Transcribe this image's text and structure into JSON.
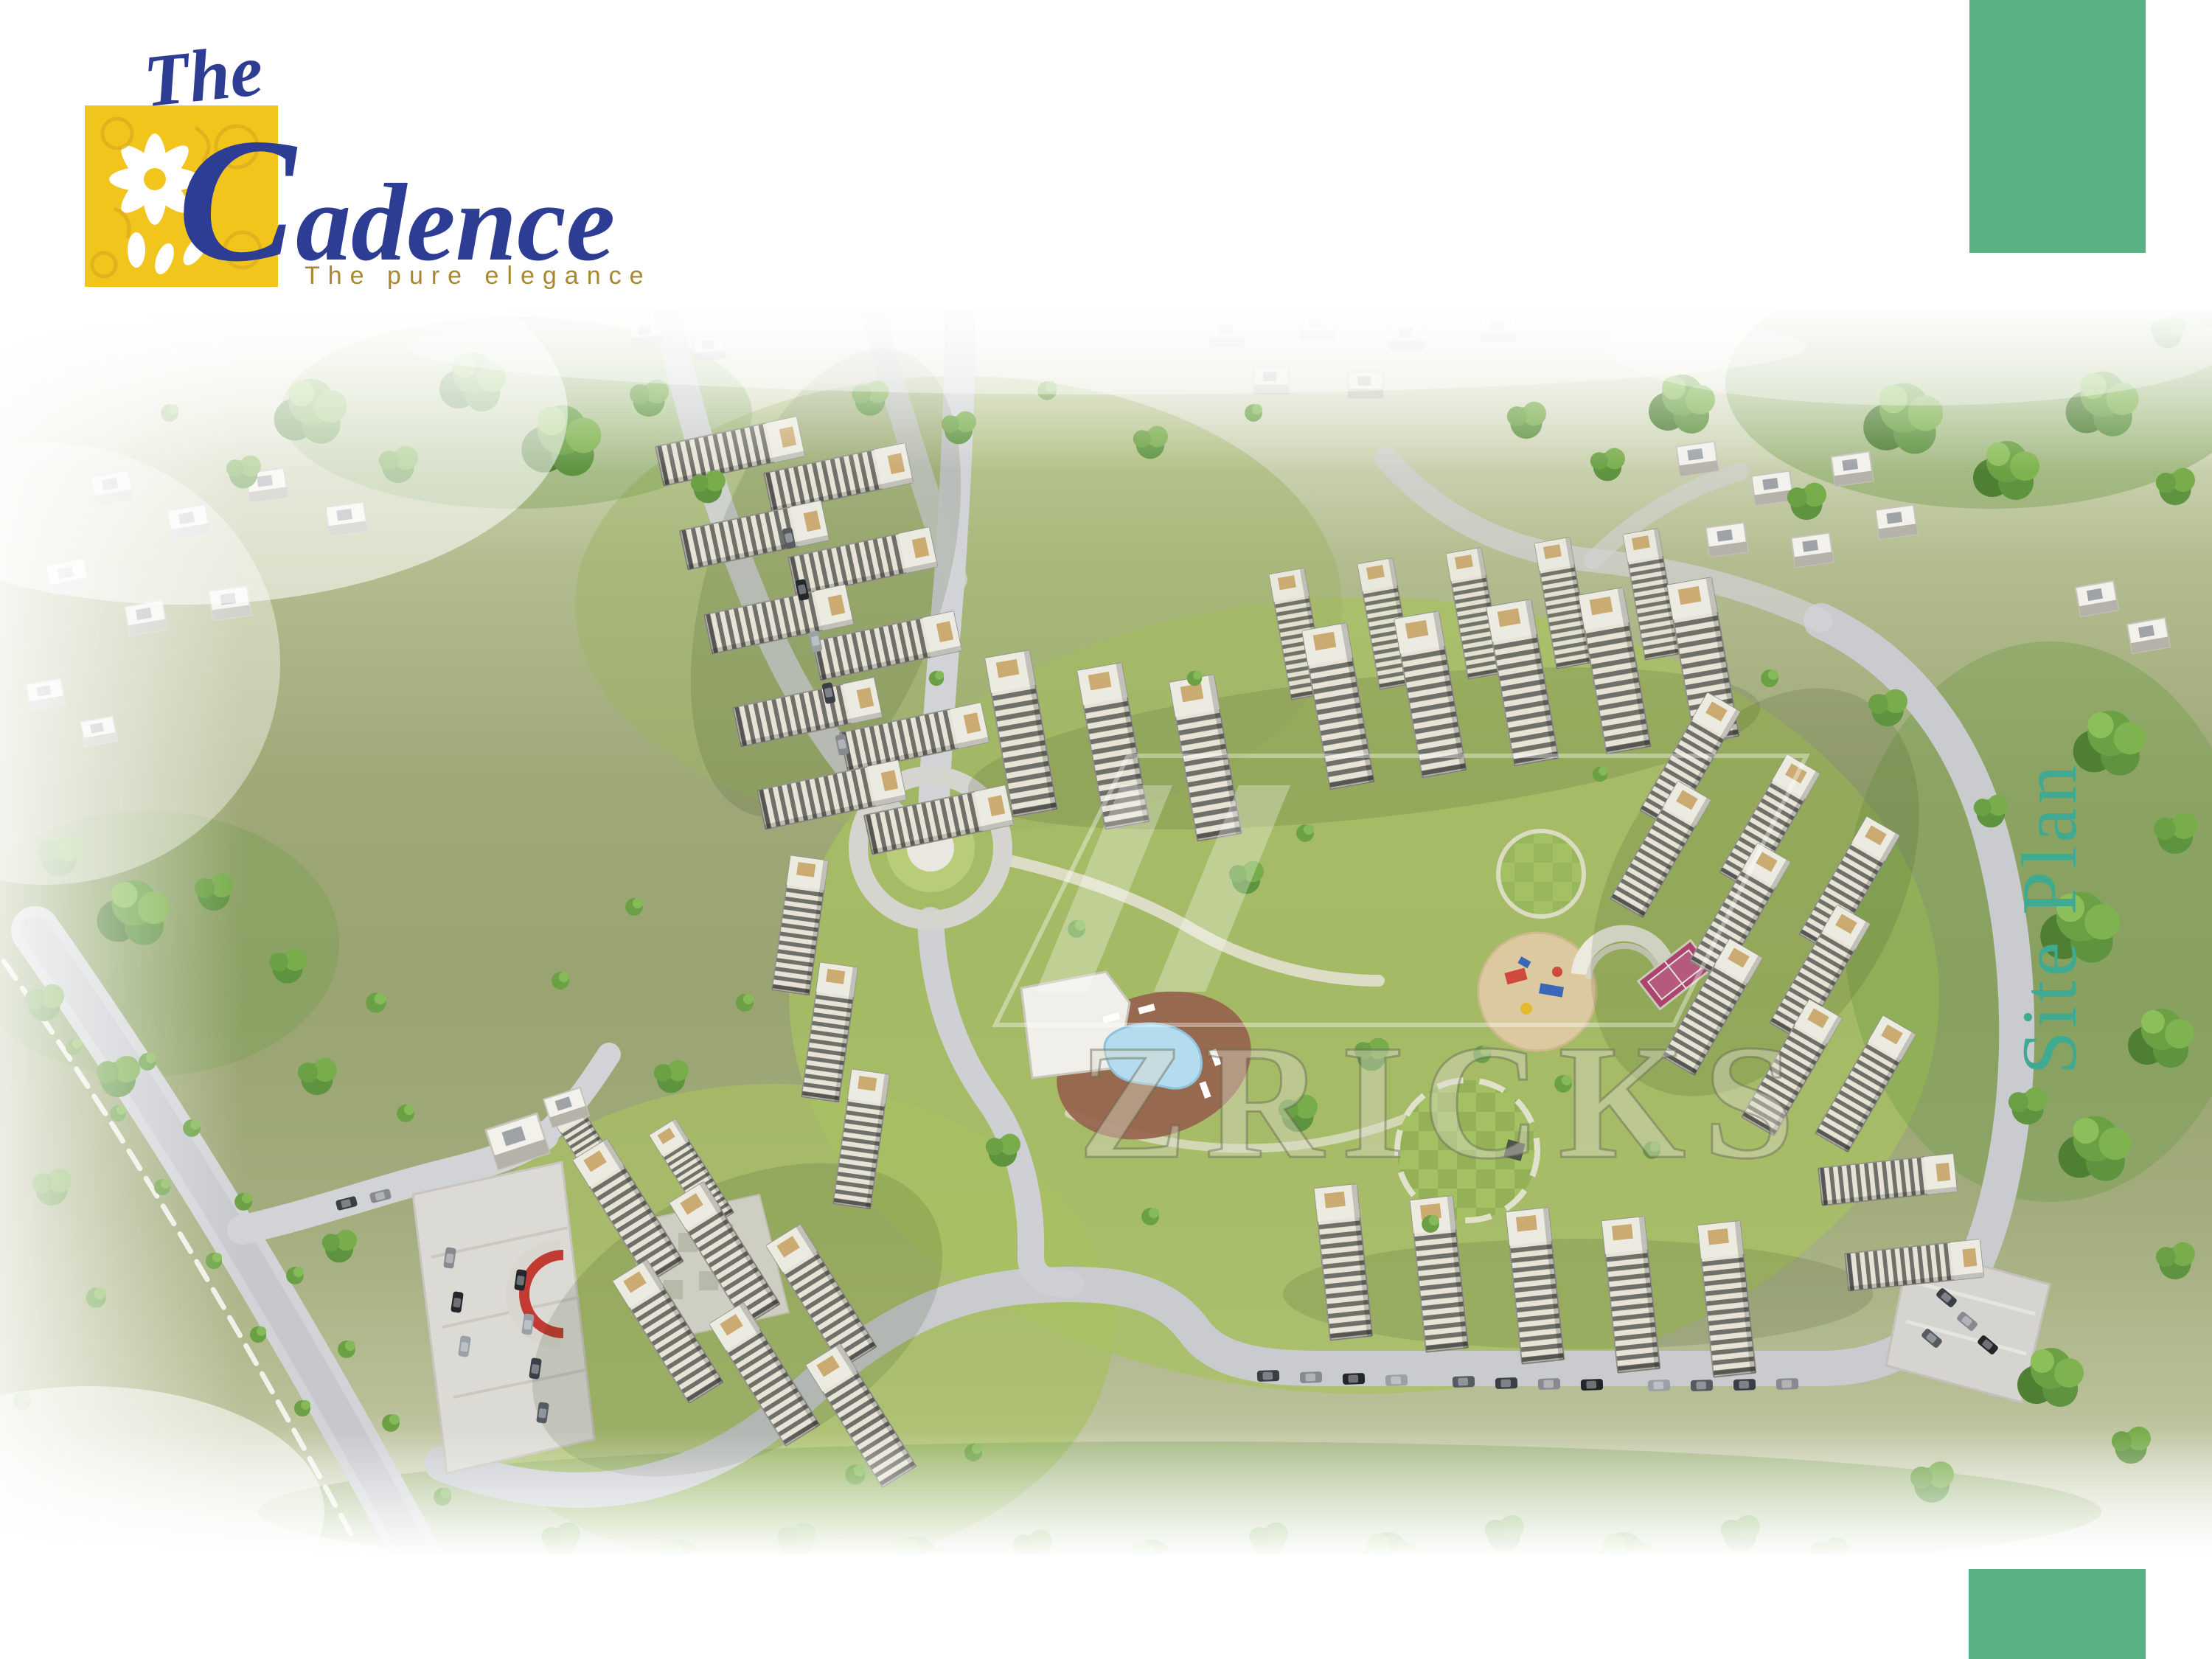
{
  "logo": {
    "prefix": "The",
    "name": "Cadence",
    "tagline": "The pure elegance",
    "brand_blue": "#2e3d94",
    "box_gold": "#f2c51d",
    "tagline_gold": "#a8872f"
  },
  "side_label": {
    "text": "Site Plan",
    "color": "#3fa992"
  },
  "watermark": {
    "text": "ZRICKS"
  },
  "accent_blocks": {
    "color": "#58b284"
  },
  "scene_palette": {
    "grass": "#99a471",
    "bright_lawn": "#a8c162",
    "tree_green": "#5e8f3c",
    "road_gray": "#d2d3d6",
    "pool_water": "#b5dcee",
    "pool_deck": "#96604b",
    "tennis_court": "#c2457c",
    "playground_sand": "#dcc9a0",
    "red_arc": "#c23b32",
    "building_roof": "#ecebe2",
    "building_stripe": "#6f7069",
    "roof_box_tan": "#ccab72"
  }
}
